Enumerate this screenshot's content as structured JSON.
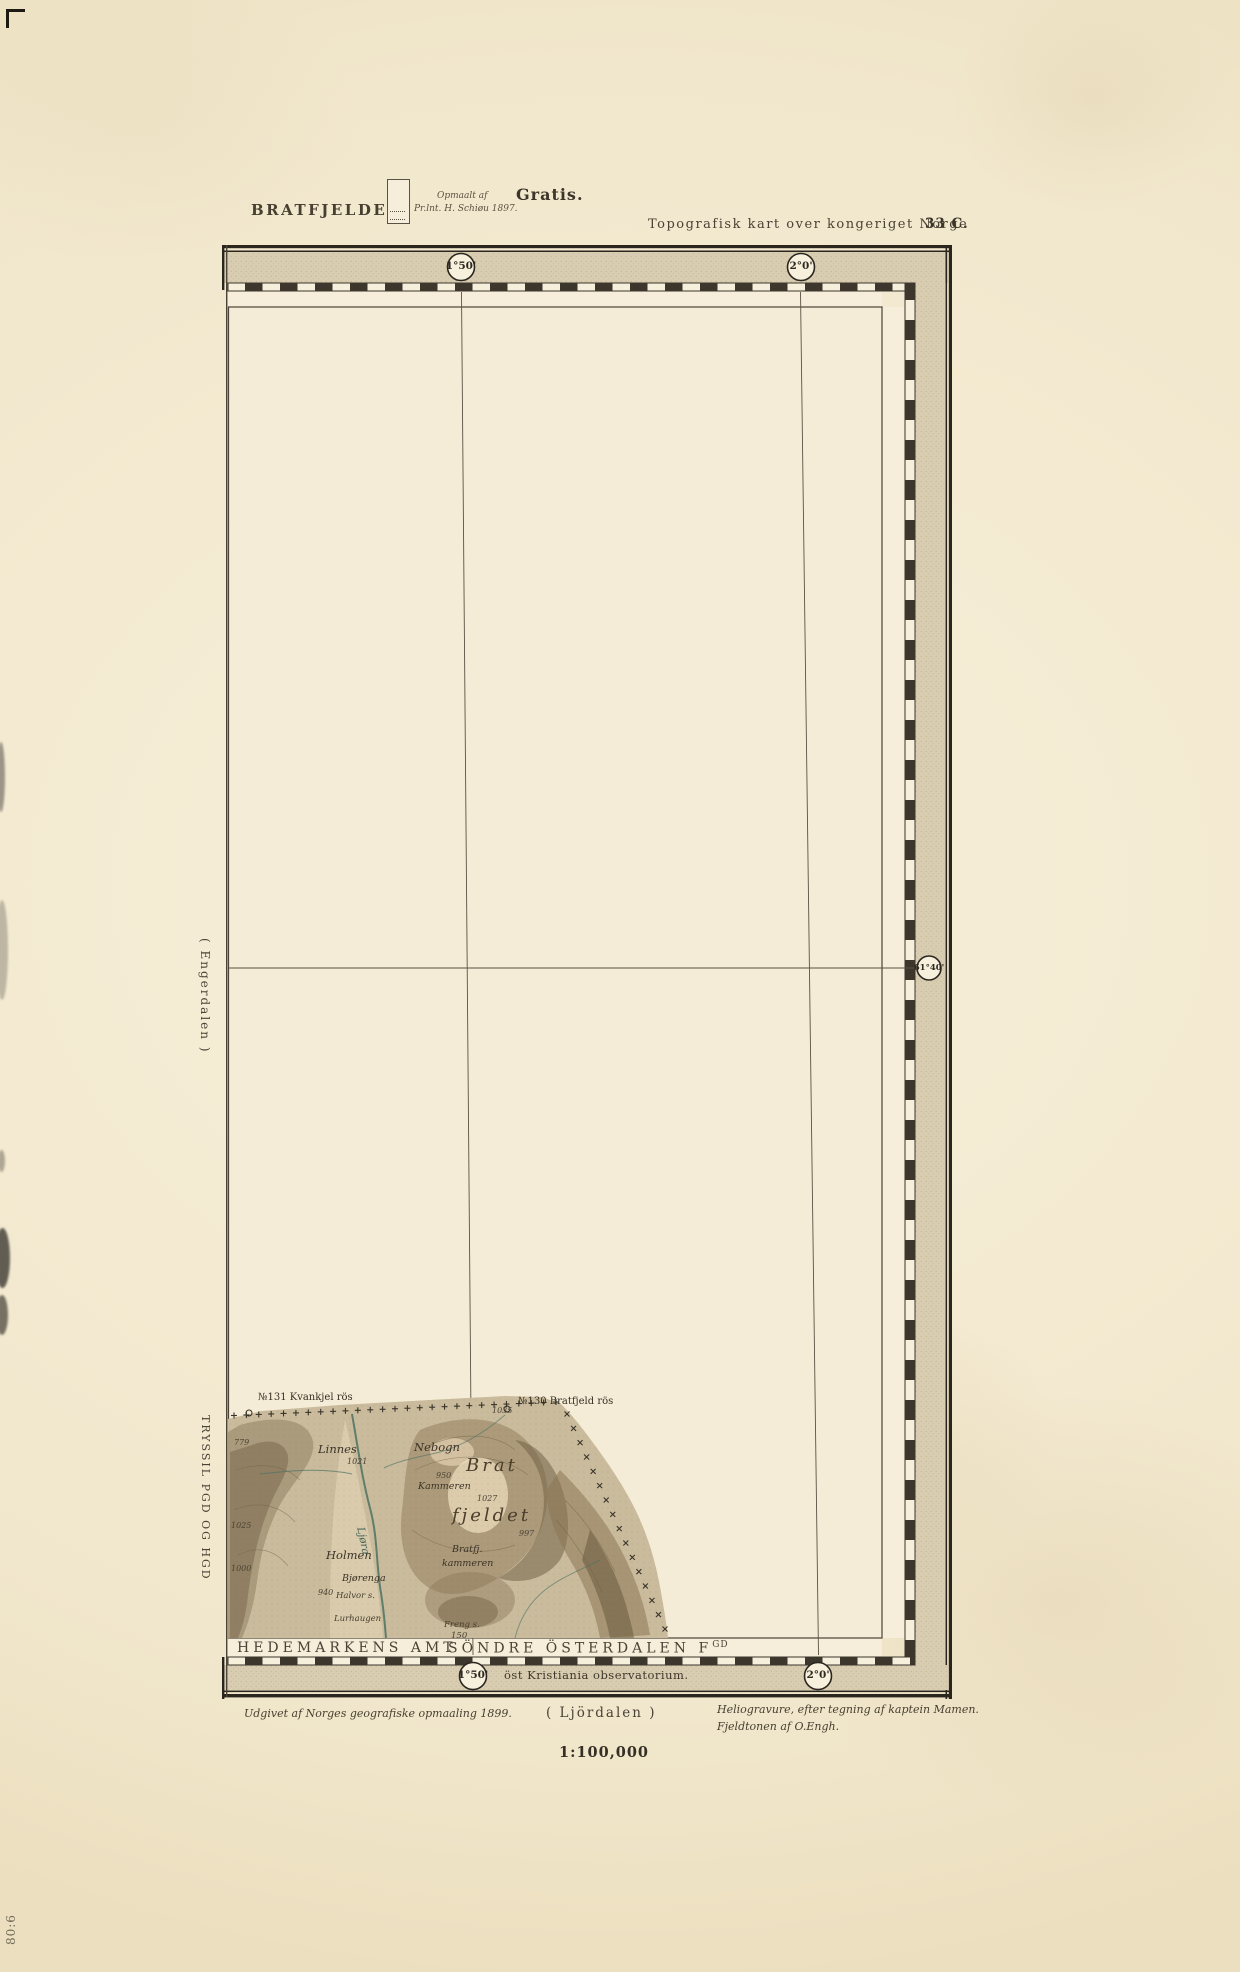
{
  "colors": {
    "paper": "#f2e8cf",
    "band": "#d8cdb1",
    "ink": "#2b2620",
    "terrain_base": "#c9bb9c",
    "river": "#4c7263"
  },
  "header": {
    "sheet_title": "BRATFJELDET.",
    "survey_line1": "Opmaalt af",
    "survey_line2": "Pr.lnt. H. Schiøu 1897.",
    "free_stamp": "Gratis.",
    "series_title": "Topografisk kart over kongeriget Norge",
    "sheet_number": "33 C."
  },
  "graticule": {
    "top_circles": [
      {
        "label": "1°50'"
      },
      {
        "label": "2°0'"
      }
    ],
    "bottom_circles": [
      {
        "label": "1°50'"
      },
      {
        "label": "2°0'"
      }
    ],
    "right_circle": {
      "label": "61°40'"
    },
    "meridian_note": "öst Kristiania observatorium."
  },
  "margins": {
    "west_sheet_north": "( Engerdalen )",
    "west_sheet_south": "TRYSSIL PGD OG HGD",
    "south_district_left": "HEDEMARKENS AMT",
    "south_district_right": "SÖNDRE ÖSTERDALEN F",
    "south_district_right_sup": "GD",
    "south_sheet": "( Ljördalen )"
  },
  "footer": {
    "published": "Udgivet af Norges geografiske opmaaling 1899.",
    "helio_line1": "Heliogravure, efter tegning af kaptein Mamen.",
    "helio_line2": "Fjeldtonen af O.Engh.",
    "scale": "1:100,000"
  },
  "handwriting": "80:6",
  "terrain_labels": [
    {
      "text": "№131 Kvankjel rös",
      "x": 258,
      "y": 1392,
      "cls": "cairn"
    },
    {
      "text": "№130 Bratfjeld rös",
      "x": 518,
      "y": 1396,
      "cls": "cairn"
    },
    {
      "text": "1035",
      "x": 492,
      "y": 1406,
      "cls": "elev"
    },
    {
      "text": "779",
      "x": 234,
      "y": 1438,
      "cls": "elev"
    },
    {
      "text": "Linnes",
      "x": 318,
      "y": 1442,
      "cls": "place"
    },
    {
      "text": "1021",
      "x": 347,
      "y": 1457,
      "cls": "elev"
    },
    {
      "text": "Nebogn",
      "x": 414,
      "y": 1440,
      "cls": "place"
    },
    {
      "text": "950",
      "x": 436,
      "y": 1471,
      "cls": "elev"
    },
    {
      "text": "Kammeren",
      "x": 418,
      "y": 1481,
      "cls": "place-sm"
    },
    {
      "text": "Brat",
      "x": 466,
      "y": 1455,
      "cls": "big"
    },
    {
      "text": "1027",
      "x": 477,
      "y": 1494,
      "cls": "elev"
    },
    {
      "text": "fjeldet",
      "x": 452,
      "y": 1505,
      "cls": "big"
    },
    {
      "text": "997",
      "x": 519,
      "y": 1529,
      "cls": "elev"
    },
    {
      "text": "1025",
      "x": 231,
      "y": 1521,
      "cls": "elev"
    },
    {
      "text": "1000",
      "x": 231,
      "y": 1564,
      "cls": "elev"
    },
    {
      "text": "Holmen",
      "x": 326,
      "y": 1548,
      "cls": "place"
    },
    {
      "text": "Ljøra",
      "x": 366,
      "y": 1526,
      "cls": "river",
      "rot": 78
    },
    {
      "text": "Bratfj.",
      "x": 452,
      "y": 1544,
      "cls": "place-sm"
    },
    {
      "text": "kammeren",
      "x": 442,
      "y": 1558,
      "cls": "place-sm"
    },
    {
      "text": "Bjørenga",
      "x": 342,
      "y": 1573,
      "cls": "place-sm"
    },
    {
      "text": "940",
      "x": 318,
      "y": 1588,
      "cls": "elev"
    },
    {
      "text": "Halvor s.",
      "x": 336,
      "y": 1591,
      "cls": "tiny"
    },
    {
      "text": "Lurhaugen",
      "x": 334,
      "y": 1614,
      "cls": "tiny"
    },
    {
      "text": "Freng s.",
      "x": 444,
      "y": 1620,
      "cls": "tiny"
    },
    {
      "text": "150",
      "x": 451,
      "y": 1631,
      "cls": "tiny"
    }
  ]
}
